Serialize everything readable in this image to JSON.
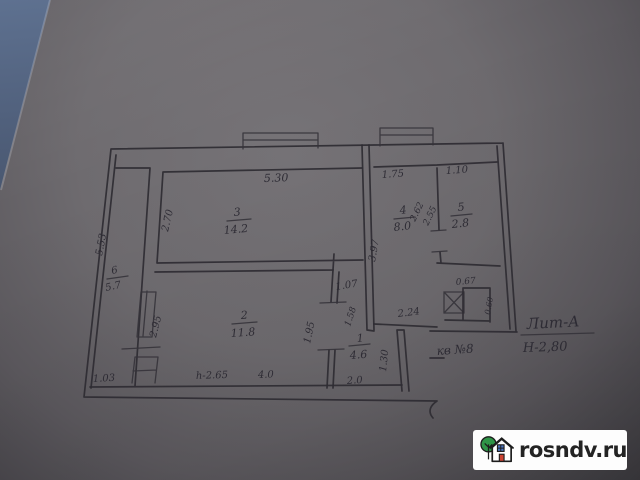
{
  "photo": {
    "description": "hand-drawn BTI apartment floor plan on grey paper",
    "paper_color": "#6e6b6f",
    "ink_color": "#2e2c33",
    "background_corner_color": "#55647f"
  },
  "plan": {
    "rooms": [
      {
        "number": "1",
        "area": "4.6"
      },
      {
        "number": "2",
        "area": "11.8"
      },
      {
        "number": "3",
        "area": "14.2"
      },
      {
        "number": "4",
        "area": "8.0"
      },
      {
        "number": "5",
        "area": "2.8"
      },
      {
        "number": "6",
        "area": "5.7"
      }
    ],
    "dims": {
      "room3_width": "5.30",
      "room4_width": "1.75",
      "room5_width": "1.10",
      "room3_height": "2.70",
      "corridor6_length": "5.53",
      "room4_height": "3.97",
      "partition45_a": "2.62",
      "partition45_b": "2.55",
      "door_room3": "1.07",
      "wall_segment": "1.58",
      "room2_height": "2.95",
      "room2_right_wall": "1.95",
      "room4_bottom": "2.24",
      "niche_width": "0.67",
      "niche_depth": "0.60",
      "hall_right_wall": "1.30",
      "corridor6_bottom": "1.03",
      "room2_note": "h-2.65",
      "room2_width": "4.0",
      "hall_width": "2.0"
    },
    "notes": {
      "liter": "Лит-А",
      "building_height": "Н-2,80",
      "apartment": "кв №8"
    }
  },
  "watermark": {
    "site": "rosndv.ru",
    "icon": "house-with-tree-icon",
    "tree_color": "#2f9447",
    "window_color": "#4a73c0",
    "door_color": "#cc4433",
    "box_color": "#fdfdfd"
  }
}
